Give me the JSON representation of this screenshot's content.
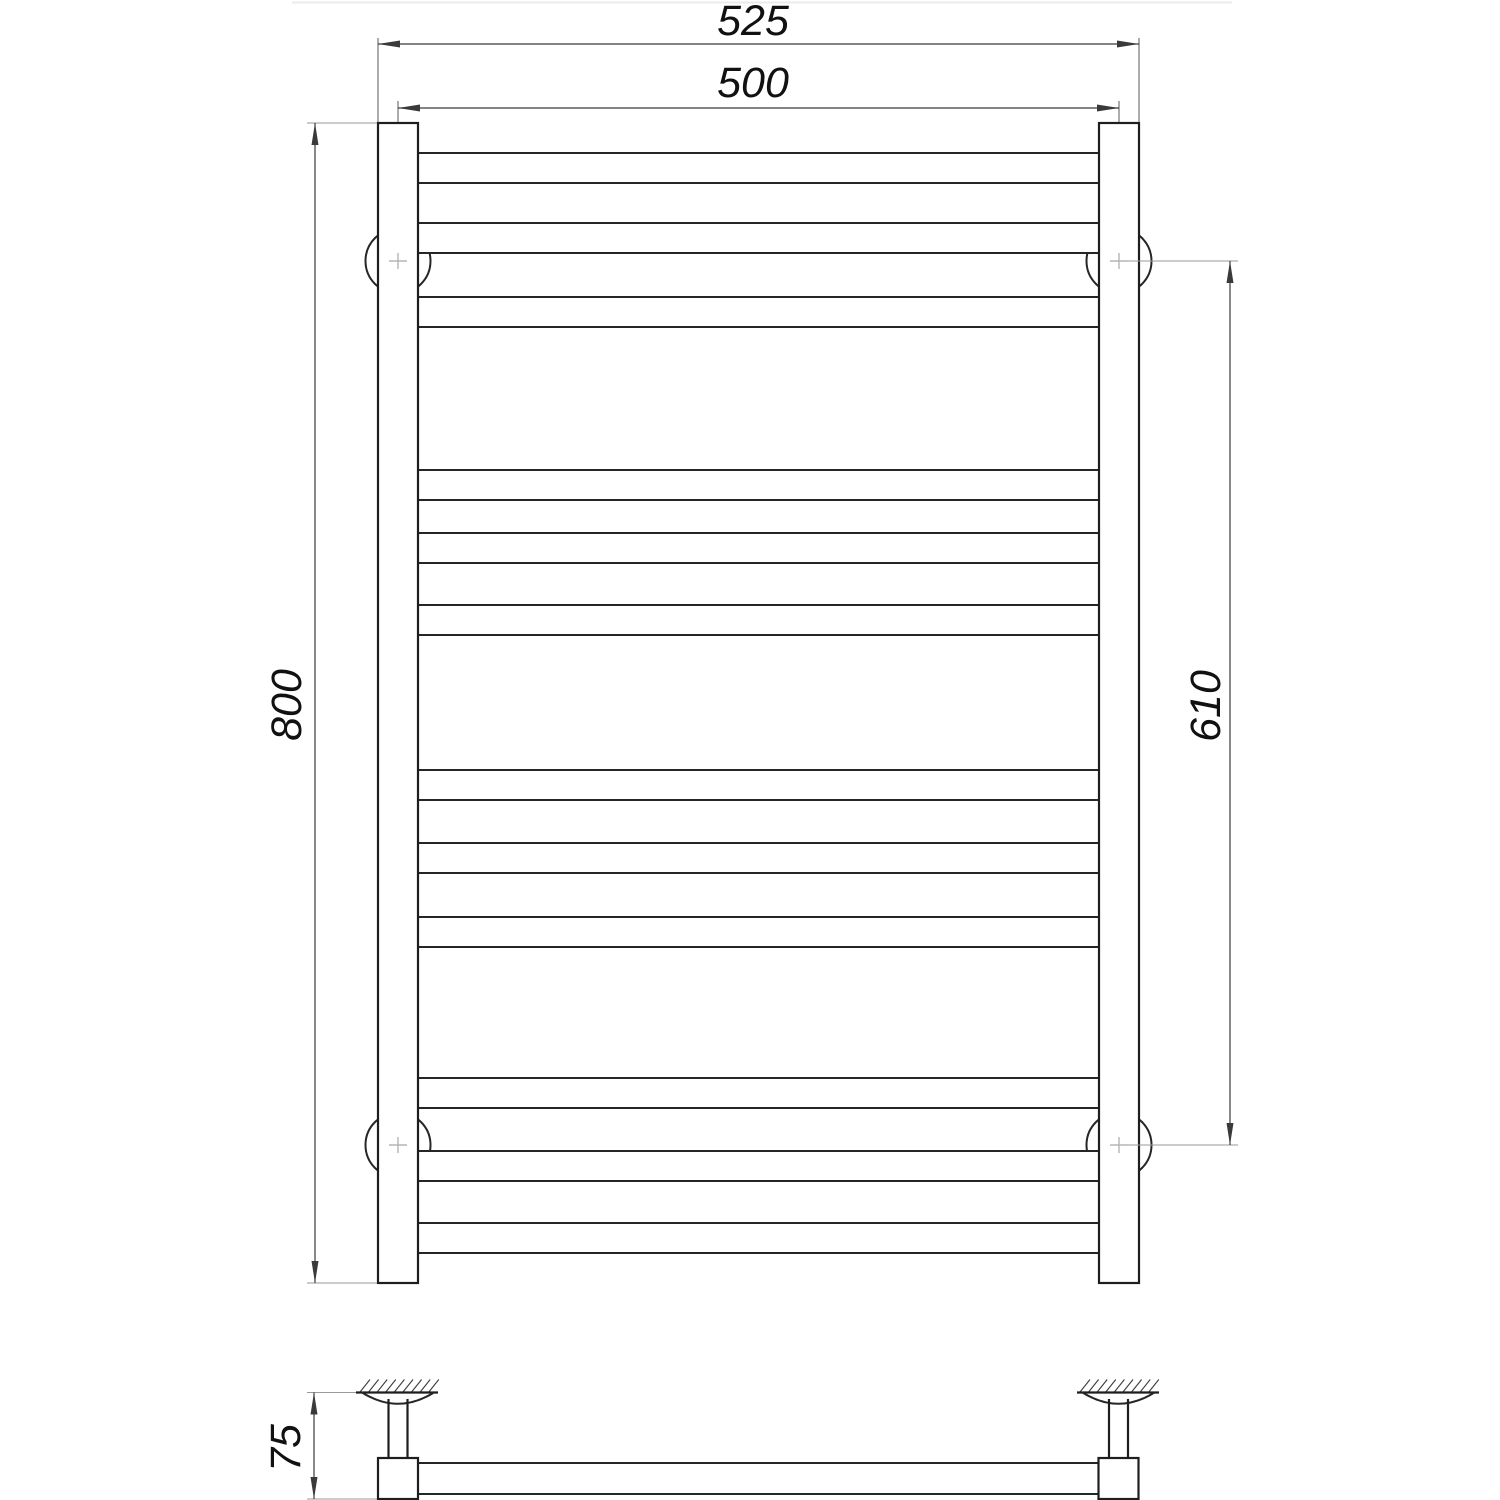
{
  "page": {
    "background": "#ffffff",
    "line_color": "#1e1e1e",
    "dim_line_color": "#3a3a3a",
    "center_mark_color": "#b5b5b5"
  },
  "drawing": {
    "type": "technical-drawing",
    "subject": "ladder towel rail, front and side views with dimensions",
    "dimensions": {
      "overall_width": "525",
      "axis_width": "500",
      "overall_height": "800",
      "bracket_spacing": "610",
      "wall_offset": "75"
    },
    "front": {
      "rung_count": 12,
      "rung_tops": [
        153,
        223,
        297,
        470,
        533,
        605,
        770,
        843,
        917,
        1078,
        1151,
        1223
      ],
      "rung_thickness": 30,
      "rung_span_x": [
        400,
        1117
      ],
      "rail_left_x": 378,
      "rail_right_x": 1099,
      "rail_width": 40,
      "rail_top_y": 123,
      "rail_bottom_y": 1283,
      "bracket_centers": [
        [
          398,
          261
        ],
        [
          1119,
          261
        ],
        [
          398,
          1145
        ],
        [
          1119,
          1145
        ]
      ],
      "bracket_radius": 32.5
    },
    "side": {
      "wall_y": 1392.5,
      "bracket_count": 2,
      "left_center_x": 398,
      "right_center_x": 1118.5,
      "bar_y": [
        1463,
        1494
      ],
      "foot_size": 40
    }
  }
}
